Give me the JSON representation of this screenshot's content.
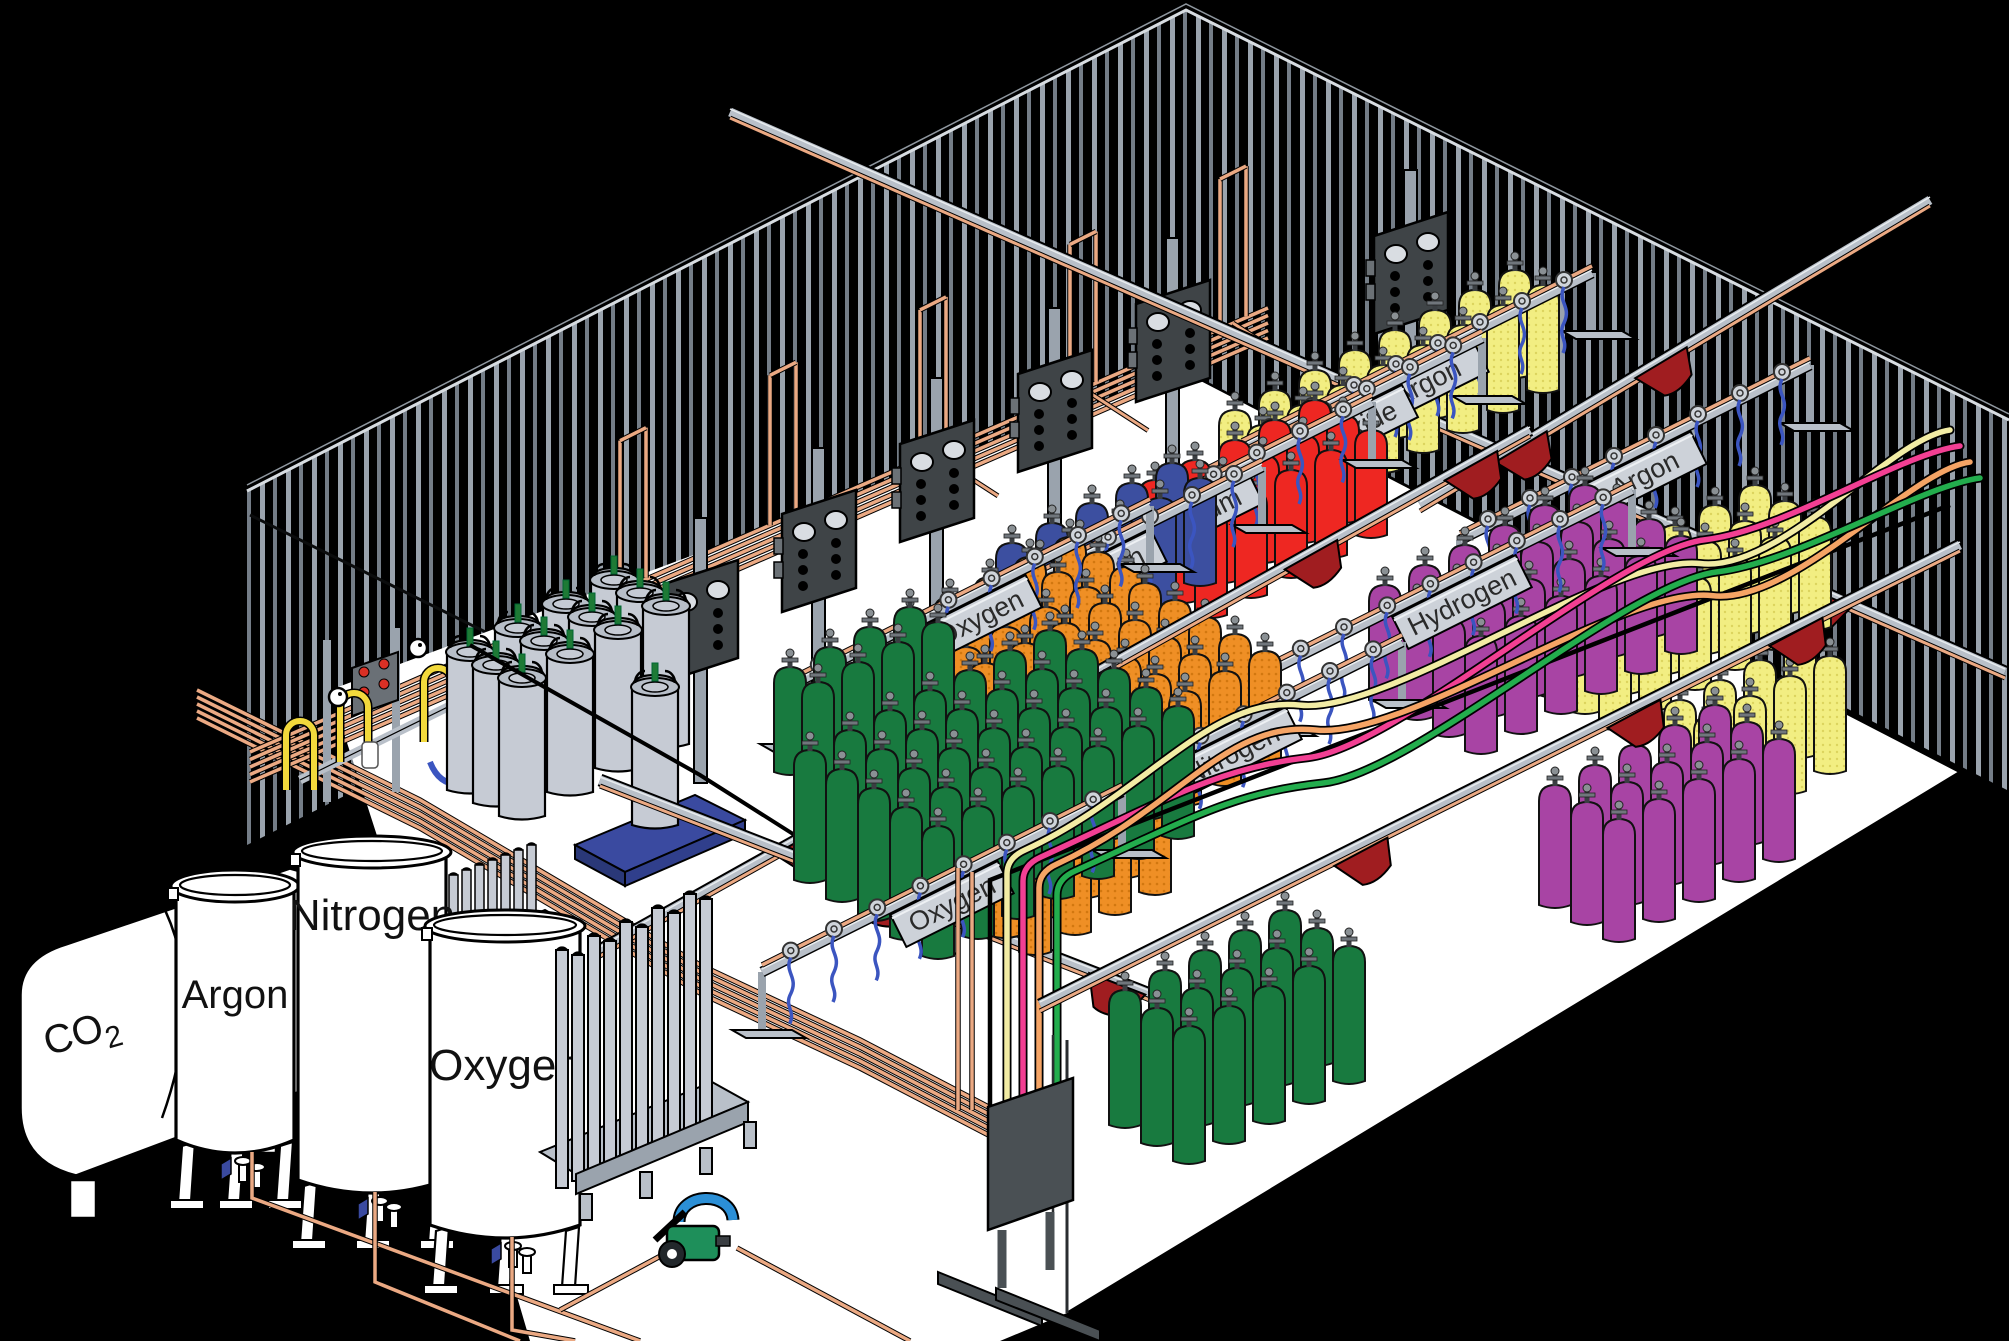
{
  "storage_tanks": [
    {
      "id": "co2-tank",
      "label": "CO2",
      "style": "horizontal-bullet"
    },
    {
      "id": "argon-tank",
      "label": "Argon",
      "style": "vertical"
    },
    {
      "id": "nitrogen-tank",
      "label": "Nitrogen",
      "style": "vertical"
    },
    {
      "id": "oxygen-tank",
      "label": "Oxygen",
      "style": "vertical"
    }
  ],
  "rack_signs": [
    {
      "id": "rack-sign-oxygen-back",
      "label": "Oxygen"
    },
    {
      "id": "rack-sign-nitrogen-back",
      "label": "Nitrogen"
    },
    {
      "id": "rack-sign-helium",
      "label": "Helium"
    },
    {
      "id": "rack-sign-carbon-dioxide",
      "label": "Carbon Dioxide"
    },
    {
      "id": "rack-sign-argon-back",
      "label": "Argon"
    },
    {
      "id": "rack-sign-argon-right",
      "label": "Argon"
    },
    {
      "id": "rack-sign-hydrogen",
      "label": "Hydrogen"
    },
    {
      "id": "rack-sign-nitrogen-front",
      "label": "Nitrogen"
    },
    {
      "id": "rack-sign-oxygen-front",
      "label": "Oxygen"
    }
  ],
  "cylinder_groups": [
    {
      "id": "yellow-cylinders-back",
      "color": "yellow",
      "rows": 2,
      "per_row": 8
    },
    {
      "id": "red-cylinders",
      "color": "red",
      "rows": 3,
      "per_row": 5
    },
    {
      "id": "blue-cylinders",
      "color": "blue",
      "rows": 2,
      "per_row": 5
    },
    {
      "id": "orange-cylinders-back",
      "color": "orange",
      "rows": 3,
      "per_row": 5
    },
    {
      "id": "green-cylinders-back",
      "color": "green",
      "rows": 2,
      "per_row": 4
    },
    {
      "id": "yellow-cylinders-right",
      "color": "yellow",
      "rows": 3,
      "per_row": 6
    },
    {
      "id": "yellow-cylinders-right-front",
      "color": "yellow",
      "rows": 2,
      "per_row": 4
    },
    {
      "id": "purple-cylinders",
      "color": "purple",
      "rows": 4,
      "per_row": 6
    },
    {
      "id": "purple-cylinders-front",
      "color": "purple",
      "rows": 3,
      "per_row": 5
    },
    {
      "id": "orange-cylinders-front",
      "color": "orange",
      "rows": 5,
      "per_row": 5
    },
    {
      "id": "orange-cylinders-corner",
      "color": "orange",
      "rows": 2,
      "per_row": 4
    },
    {
      "id": "green-cylinders-front",
      "color": "green",
      "rows": 5,
      "per_row": 7
    },
    {
      "id": "green-cylinders-corner",
      "color": "green",
      "rows": 3,
      "per_row": 5
    }
  ],
  "cylinder_colors": {
    "green": "#187A3F",
    "orange": "#EF8F25",
    "blue": "#3C4FA0",
    "red": "#EE2722",
    "yellow": "#F2EE82",
    "purple": "#A844A4"
  },
  "hoses": [
    {
      "id": "hose-cream",
      "color": "#F2ECA4"
    },
    {
      "id": "hose-pink",
      "color": "#F23F93"
    },
    {
      "id": "hose-salmon",
      "color": "#F5A465"
    },
    {
      "id": "hose-green",
      "color": "#23AD4D"
    }
  ],
  "palette": {
    "background": "#000000",
    "floor": "#FFFFFF",
    "wall_stripe": "#9AA3AD",
    "wall_stripe_dim": "#747D87",
    "copper_pipe": "#EBA983",
    "rail_gray": "#B9C0C9",
    "rail_light": "#E8ECEF",
    "sign_plate": "#CDD2D9",
    "sign_text": "#2A2A2A",
    "panel_dark": "#3F4447",
    "post_gray": "#9AA3AD",
    "panel_tab": "#6B7176",
    "carrier_red": "#A01D20",
    "pigtail_blue": "#3B55C0",
    "dewar_gray": "#C6CBD4",
    "dewar_rim": "#B7BEC8",
    "pallet_blue": "#3A4AA0",
    "fill_pipe_yellow": "#F2D93C",
    "valve_green": "#1E7A35",
    "pump_body_green": "#1E8F5A",
    "pump_pipe_blue": "#2B8FD6",
    "tank_white": "#FFFFFF",
    "outline": "#000000",
    "orange_dot": "#D2770F",
    "yellow_dot": "#DCD45E",
    "gauge_face": "#D9DDE2",
    "valve_wheel": "#CFD4DA"
  }
}
